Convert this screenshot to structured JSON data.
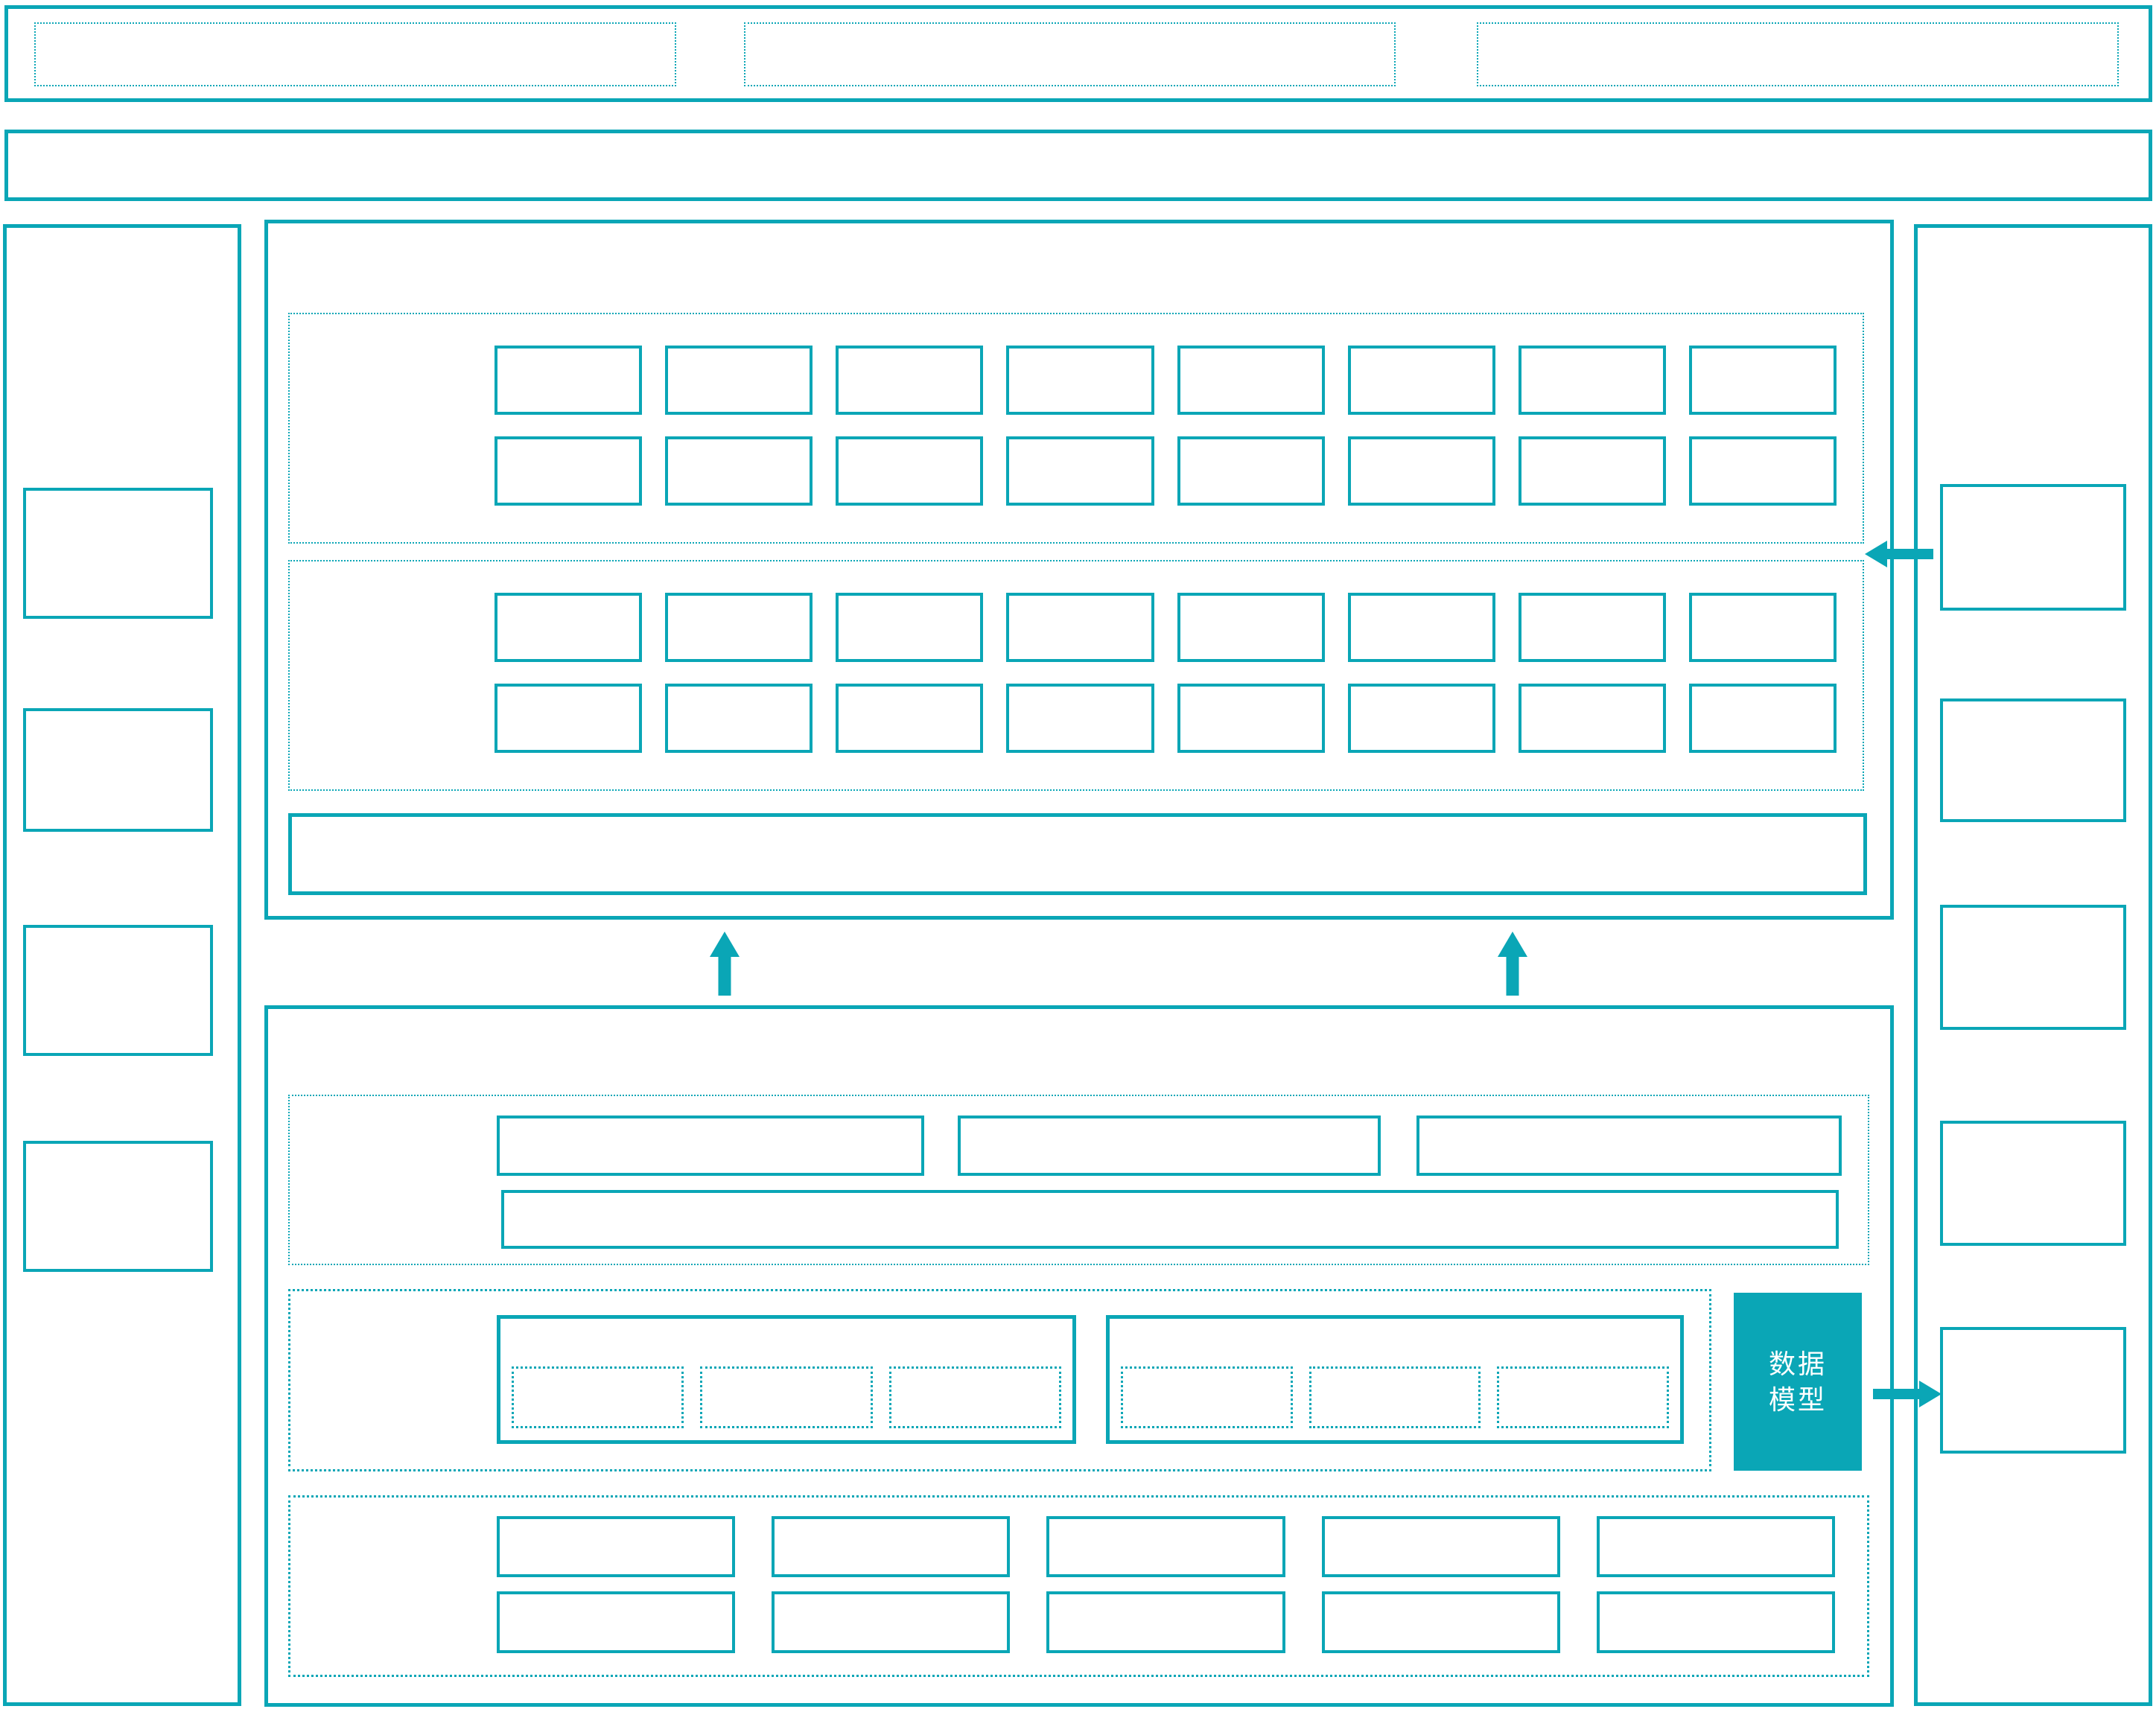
{
  "colors": {
    "accent": "#0AA6B6",
    "background": "#FFFFFF",
    "data_model_fill": "#0AA6B6",
    "data_model_text": "#FFFFFF"
  },
  "labels": {
    "data_model": "数据模型"
  },
  "structure": {
    "top_bar": {
      "slot_count": 3
    },
    "ribbon_bar": {
      "empty": true
    },
    "left_panel": {
      "box_count": 4
    },
    "right_panel": {
      "box_count": 5
    },
    "upper_module": {
      "grid_sections": [
        {
          "rows": 2,
          "cols": 8,
          "cells": 16
        },
        {
          "rows": 2,
          "cols": 8,
          "cells": 16
        }
      ],
      "wide_bar": true
    },
    "lower_module": {
      "row_section": {
        "box_count": 3,
        "wide_bar": true
      },
      "group_section": {
        "group_count": 2,
        "slots_per_group": 3
      },
      "grid_section": {
        "rows": 2,
        "cols": 5,
        "cells": 10
      }
    },
    "arrows": [
      {
        "name": "up-arrow-left",
        "direction": "up"
      },
      {
        "name": "up-arrow-right",
        "direction": "up"
      },
      {
        "name": "right-panel-to-upper-module",
        "direction": "left"
      },
      {
        "name": "data-model-to-right-panel",
        "direction": "right"
      }
    ]
  }
}
